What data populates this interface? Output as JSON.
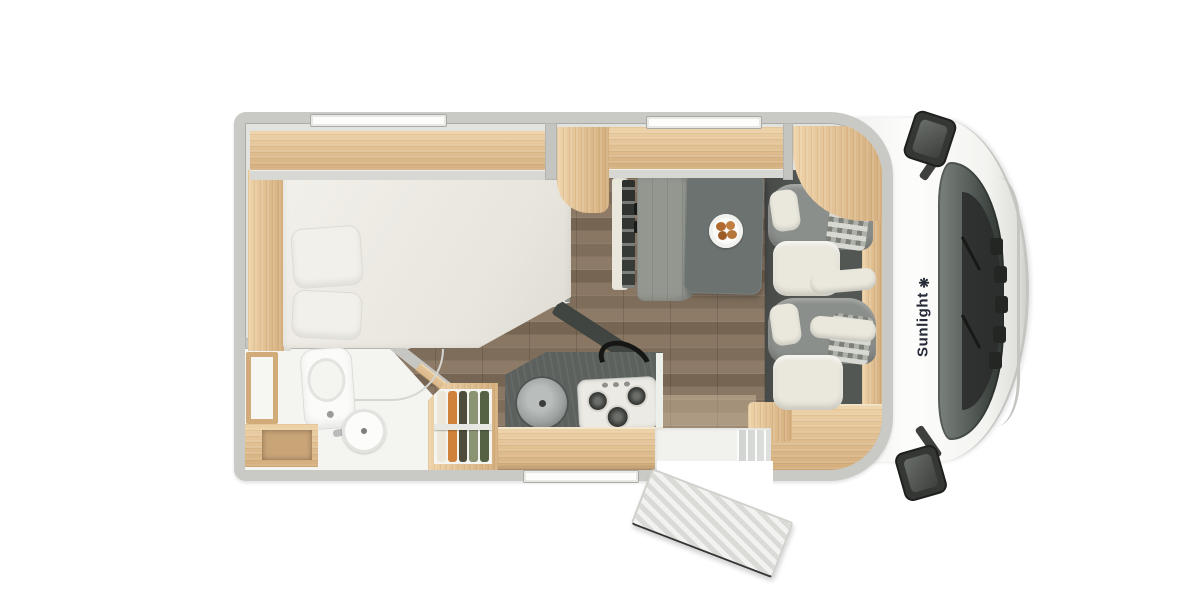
{
  "brand": {
    "name": "Sunlight",
    "icon_glyph": "❋"
  },
  "view": {
    "description_label": ""
  },
  "colors": {
    "wall": "#c9c9c6",
    "wall_line": "#aaaaa6",
    "wood": "#e6c79b",
    "wood_deep": "#d2ab7a",
    "floor_plank": "#84735f",
    "slate_floor": "#8e948f",
    "kitchen_counter": "#5c615e",
    "backsplash": "#404542",
    "bench": "#939790",
    "table": "#6c7270",
    "cab_floor": "#535754",
    "seat_gray": "#8b8f8b",
    "seat_cream": "#eae8dd",
    "checker_light": "#d9d9d4",
    "checker_dark": "#7c8079",
    "bed": "#eeece5",
    "bathroom": "#f4f4f1",
    "steel_sink": "#9aa09e",
    "burner": "#3a3c39",
    "windshield": "#4d544f",
    "cowl": "#2b2e2c",
    "mirror": "#343734",
    "cab_white": "#f7f7f5",
    "chrome": "#c4c4c1",
    "brand_ink": "#242936",
    "clothes_1": "#ece7d8",
    "clothes_2": "#d0813a",
    "clothes_3": "#4e4c3a",
    "clothes_4": "#8a9473",
    "clothes_5": "#556244",
    "food": "#b06a2e"
  }
}
